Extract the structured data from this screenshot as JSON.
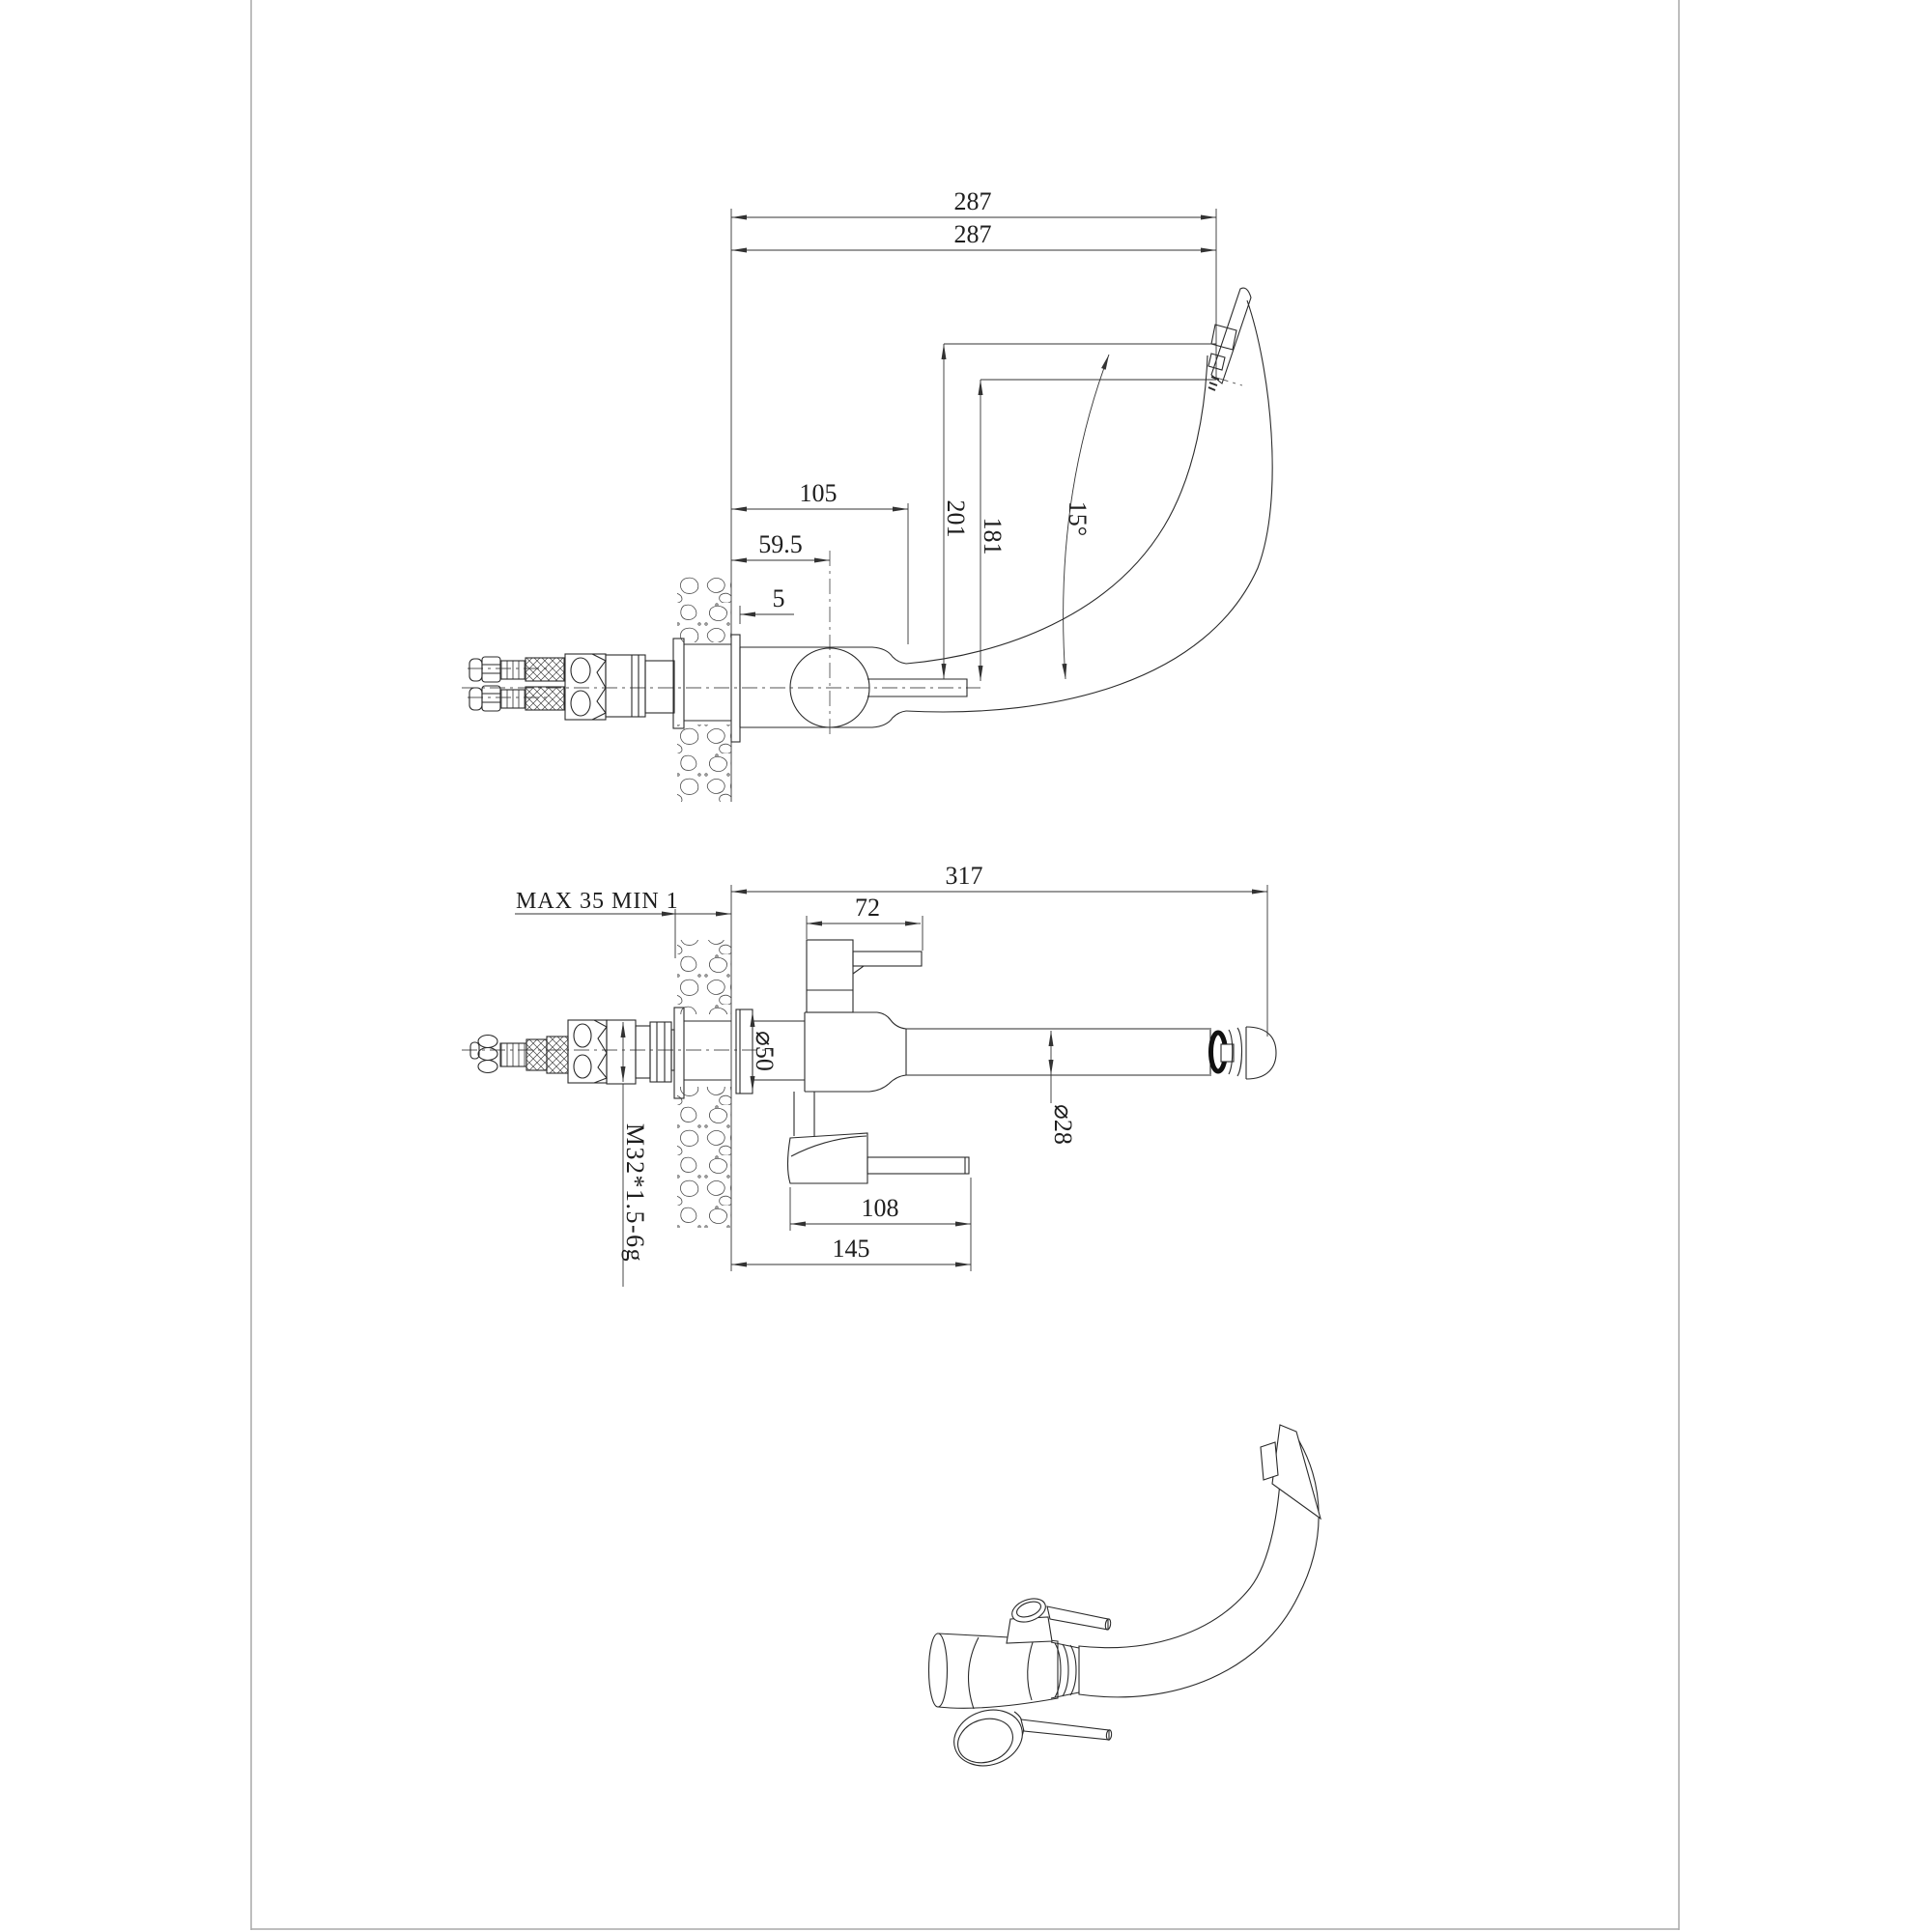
{
  "document": {
    "type": "technical-drawing",
    "subject": "kitchen-faucet-installation-views"
  },
  "dims": {
    "top": {
      "reach_upper": "287",
      "reach_lower": "287",
      "body_len": "105",
      "center_off": "59.5",
      "plate_gap": "5",
      "h_outer": "201",
      "h_inner": "181",
      "tip_angle": "15°"
    },
    "mid": {
      "total": "317",
      "handle": "72",
      "wall_note": "MAX 35 MIN 1",
      "flange_dia": "⌀50",
      "spout_dia": "⌀28",
      "thread": "M32*1.5-6g",
      "lever": "108",
      "lever_total": "145"
    }
  },
  "colors": {
    "paper": "#ffffff",
    "object_line": "#2a2a2a",
    "dim_line": "#333333",
    "center_line": "#555555",
    "frame_line": "#a9a9a9",
    "aerator_fill": "#111111"
  }
}
